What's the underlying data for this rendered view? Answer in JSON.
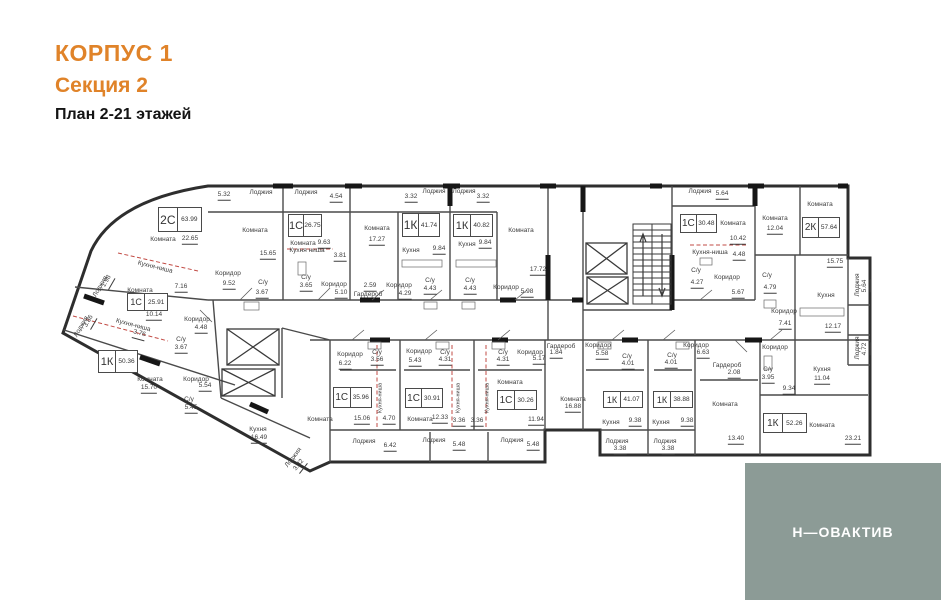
{
  "header": {
    "building": "КОРПУС 1",
    "section": "Секция 2",
    "plan_title": "План 2-21 этажей"
  },
  "logo": {
    "text": "Н—ОВАКТИВ",
    "bg": "#8C9B96"
  },
  "colors": {
    "accent_orange": "#E08329",
    "wall_dark": "#2E2E2E",
    "wall_inner": "#4A4A4A",
    "red_dashed": "#C24B45",
    "logo_bg": "#8C9B96"
  },
  "plan": {
    "apartments": [
      {
        "type": "2С",
        "area": "63.99",
        "x": 158,
        "y": 207,
        "w": 44,
        "h": 25
      },
      {
        "type": "1С",
        "area": "26.75",
        "x": 288,
        "y": 214,
        "w": 34,
        "h": 23
      },
      {
        "type": "1К",
        "area": "41.74",
        "x": 402,
        "y": 213,
        "w": 38,
        "h": 24
      },
      {
        "type": "1К",
        "area": "40.82",
        "x": 453,
        "y": 214,
        "w": 40,
        "h": 23
      },
      {
        "type": "1С",
        "area": "30.48",
        "x": 680,
        "y": 214,
        "w": 37,
        "h": 19
      },
      {
        "type": "2К",
        "area": "57.64",
        "x": 802,
        "y": 217,
        "w": 38,
        "h": 21
      },
      {
        "type": "1С",
        "area": "25.91",
        "x": 127,
        "y": 293,
        "w": 41,
        "h": 18
      },
      {
        "type": "1К",
        "area": "50.36",
        "x": 98,
        "y": 350,
        "w": 40,
        "h": 23
      },
      {
        "type": "1С",
        "area": "35.96",
        "x": 333,
        "y": 387,
        "w": 39,
        "h": 21
      },
      {
        "type": "1С",
        "area": "30.91",
        "x": 405,
        "y": 388,
        "w": 38,
        "h": 20
      },
      {
        "type": "1С",
        "area": "30.26",
        "x": 497,
        "y": 390,
        "w": 40,
        "h": 20
      },
      {
        "type": "1К",
        "area": "41.07",
        "x": 603,
        "y": 391,
        "w": 40,
        "h": 17
      },
      {
        "type": "1К",
        "area": "38.88",
        "x": 653,
        "y": 391,
        "w": 40,
        "h": 17
      },
      {
        "type": "1К",
        "area": "52.26",
        "x": 763,
        "y": 413,
        "w": 44,
        "h": 20
      }
    ],
    "labels": [
      {
        "t": "5.32",
        "x": 224,
        "y": 196,
        "u": 1
      },
      {
        "t": "Лоджия",
        "x": 261,
        "y": 193
      },
      {
        "t": "Лоджия",
        "x": 306,
        "y": 193
      },
      {
        "t": "4.54",
        "x": 336,
        "y": 198,
        "u": 1
      },
      {
        "t": "3.32",
        "x": 411,
        "y": 198,
        "u": 1
      },
      {
        "t": "Лоджия",
        "x": 434,
        "y": 192
      },
      {
        "t": "Лоджия",
        "x": 464,
        "y": 192
      },
      {
        "t": "3.32",
        "x": 483,
        "y": 198,
        "u": 1
      },
      {
        "t": "Лоджия",
        "x": 700,
        "y": 192
      },
      {
        "t": "5.64",
        "x": 722,
        "y": 195,
        "u": 1
      },
      {
        "t": "Комната",
        "x": 163,
        "y": 240
      },
      {
        "t": "22.65",
        "x": 190,
        "y": 240,
        "u": 1
      },
      {
        "t": "Комната",
        "x": 255,
        "y": 231
      },
      {
        "t": "15.65",
        "x": 268,
        "y": 255,
        "u": 1
      },
      {
        "t": "Кухня-ниша",
        "x": 155,
        "y": 268,
        "r": 14
      },
      {
        "t": "7.16",
        "x": 181,
        "y": 288,
        "u": 1
      },
      {
        "t": "Коридор",
        "x": 228,
        "y": 274
      },
      {
        "t": "9.52",
        "x": 229,
        "y": 285,
        "u": 1
      },
      {
        "t": "С/у",
        "x": 263,
        "y": 283
      },
      {
        "t": "3.67",
        "x": 262,
        "y": 294,
        "u": 1
      },
      {
        "t": "Комната",
        "x": 303,
        "y": 244
      },
      {
        "t": "9.63",
        "x": 324,
        "y": 244,
        "u": 1
      },
      {
        "t": "Кухня ниша",
        "x": 307,
        "y": 251
      },
      {
        "t": "3.81",
        "x": 340,
        "y": 257,
        "u": 1
      },
      {
        "t": "С/у",
        "x": 306,
        "y": 278
      },
      {
        "t": "3.65",
        "x": 306,
        "y": 287,
        "u": 1
      },
      {
        "t": "Коридор",
        "x": 334,
        "y": 285
      },
      {
        "t": "5.10",
        "x": 341,
        "y": 294,
        "u": 1
      },
      {
        "t": "2.59",
        "x": 370,
        "y": 287,
        "u": 1
      },
      {
        "t": "Гардероб",
        "x": 368,
        "y": 295
      },
      {
        "t": "Комната",
        "x": 377,
        "y": 229
      },
      {
        "t": "17.27",
        "x": 377,
        "y": 241,
        "u": 1
      },
      {
        "t": "Кухня",
        "x": 411,
        "y": 251
      },
      {
        "t": "9.84",
        "x": 439,
        "y": 250,
        "u": 1
      },
      {
        "t": "Коридор",
        "x": 399,
        "y": 286
      },
      {
        "t": "4.29",
        "x": 405,
        "y": 295,
        "u": 1
      },
      {
        "t": "С/у",
        "x": 430,
        "y": 281
      },
      {
        "t": "4.43",
        "x": 430,
        "y": 290,
        "u": 1
      },
      {
        "t": "Кухня",
        "x": 467,
        "y": 245
      },
      {
        "t": "9.84",
        "x": 485,
        "y": 244,
        "u": 1
      },
      {
        "t": "С/у",
        "x": 470,
        "y": 281
      },
      {
        "t": "4.43",
        "x": 470,
        "y": 290,
        "u": 1
      },
      {
        "t": "Комната",
        "x": 521,
        "y": 231
      },
      {
        "t": "17.72",
        "x": 538,
        "y": 271,
        "u": 1
      },
      {
        "t": "Коридор",
        "x": 506,
        "y": 288
      },
      {
        "t": "5.98",
        "x": 527,
        "y": 293,
        "u": 1
      },
      {
        "t": "Комната",
        "x": 733,
        "y": 224
      },
      {
        "t": "10.42",
        "x": 738,
        "y": 240,
        "u": 1
      },
      {
        "t": "Кухня-ниша",
        "x": 710,
        "y": 253
      },
      {
        "t": "4.48",
        "x": 739,
        "y": 256,
        "u": 1
      },
      {
        "t": "С/у",
        "x": 696,
        "y": 271
      },
      {
        "t": "4.27",
        "x": 697,
        "y": 284,
        "u": 1
      },
      {
        "t": "Коридор",
        "x": 727,
        "y": 278
      },
      {
        "t": "5.67",
        "x": 738,
        "y": 294,
        "u": 1
      },
      {
        "t": "Комната",
        "x": 820,
        "y": 205
      },
      {
        "t": "Комната",
        "x": 775,
        "y": 219
      },
      {
        "t": "12.04",
        "x": 775,
        "y": 230,
        "u": 1
      },
      {
        "t": "15.75",
        "x": 835,
        "y": 263,
        "u": 1
      },
      {
        "t": "С/у",
        "x": 767,
        "y": 276
      },
      {
        "t": "4.79",
        "x": 770,
        "y": 289,
        "u": 1
      },
      {
        "t": "Кухня",
        "x": 826,
        "y": 296
      },
      {
        "t": "12.17",
        "x": 833,
        "y": 328,
        "u": 1
      },
      {
        "t": "Коридор",
        "x": 784,
        "y": 312
      },
      {
        "t": "7.41",
        "x": 785,
        "y": 325,
        "u": 1
      },
      {
        "t": "Лоджия",
        "x": 858,
        "y": 285,
        "r": -90
      },
      {
        "t": "5.64",
        "x": 866,
        "y": 286,
        "r": -90,
        "u": 1
      },
      {
        "t": "Лоджия",
        "x": 858,
        "y": 348,
        "r": -90
      },
      {
        "t": "4.72",
        "x": 866,
        "y": 349,
        "r": -90,
        "u": 1
      },
      {
        "t": "Лоджия",
        "x": 101,
        "y": 287,
        "r": -60
      },
      {
        "t": "1.98",
        "x": 108,
        "y": 282,
        "r": -60,
        "u": 1
      },
      {
        "t": "Лоджия",
        "x": 82,
        "y": 327,
        "r": -60
      },
      {
        "t": "3.86",
        "x": 90,
        "y": 322,
        "r": -60,
        "u": 1
      },
      {
        "t": "Комната",
        "x": 140,
        "y": 291
      },
      {
        "t": "10.14",
        "x": 154,
        "y": 316,
        "u": 1
      },
      {
        "t": "Кухня-ниша",
        "x": 133,
        "y": 326,
        "r": 15
      },
      {
        "t": "3.76",
        "x": 139,
        "y": 335,
        "u": 1,
        "r": 15
      },
      {
        "t": "Коридор",
        "x": 197,
        "y": 320
      },
      {
        "t": "4.48",
        "x": 201,
        "y": 329,
        "u": 1
      },
      {
        "t": "С/у",
        "x": 181,
        "y": 340
      },
      {
        "t": "3.67",
        "x": 181,
        "y": 349,
        "u": 1
      },
      {
        "t": "Комната",
        "x": 150,
        "y": 380
      },
      {
        "t": "15.70",
        "x": 149,
        "y": 389,
        "u": 1
      },
      {
        "t": "Коридор",
        "x": 196,
        "y": 380
      },
      {
        "t": "5.54",
        "x": 205,
        "y": 387,
        "u": 1
      },
      {
        "t": "С/у",
        "x": 189,
        "y": 400
      },
      {
        "t": "5.45",
        "x": 191,
        "y": 409,
        "u": 1
      },
      {
        "t": "Кухня",
        "x": 258,
        "y": 430
      },
      {
        "t": "16.49",
        "x": 259,
        "y": 439,
        "u": 1
      },
      {
        "t": "Лоджия",
        "x": 294,
        "y": 458,
        "r": -52
      },
      {
        "t": "3.32",
        "x": 300,
        "y": 466,
        "r": -52,
        "u": 1
      },
      {
        "t": "Коридор",
        "x": 350,
        "y": 355
      },
      {
        "t": "6.22",
        "x": 345,
        "y": 365,
        "u": 1
      },
      {
        "t": "С/у",
        "x": 377,
        "y": 353
      },
      {
        "t": "3.56",
        "x": 377,
        "y": 361,
        "u": 1
      },
      {
        "t": "Комната",
        "x": 320,
        "y": 420
      },
      {
        "t": "15.06",
        "x": 362,
        "y": 420,
        "u": 1
      },
      {
        "t": "4.70",
        "x": 389,
        "y": 420,
        "u": 1
      },
      {
        "t": "Кухня-ниша",
        "x": 381,
        "y": 398,
        "r": -90,
        "s": 5.5
      },
      {
        "t": "Коридор",
        "x": 419,
        "y": 352
      },
      {
        "t": "5.43",
        "x": 415,
        "y": 362,
        "u": 1
      },
      {
        "t": "С/у",
        "x": 445,
        "y": 353
      },
      {
        "t": "4.31",
        "x": 445,
        "y": 361,
        "u": 1
      },
      {
        "t": "Комната",
        "x": 420,
        "y": 420
      },
      {
        "t": "12.33",
        "x": 440,
        "y": 419,
        "u": 1
      },
      {
        "t": "Кухня-ниша",
        "x": 459,
        "y": 398,
        "r": -90,
        "s": 5.5
      },
      {
        "t": "3.36",
        "x": 459,
        "y": 422,
        "u": 1
      },
      {
        "t": "Кухня-ниша",
        "x": 488,
        "y": 398,
        "r": -90,
        "s": 5.5
      },
      {
        "t": "3.36",
        "x": 477,
        "y": 422,
        "u": 1
      },
      {
        "t": "С/у",
        "x": 503,
        "y": 353
      },
      {
        "t": "4.31",
        "x": 503,
        "y": 361,
        "u": 1
      },
      {
        "t": "Коридор",
        "x": 530,
        "y": 353
      },
      {
        "t": "5.17",
        "x": 539,
        "y": 360,
        "u": 1
      },
      {
        "t": "Комната",
        "x": 510,
        "y": 383
      },
      {
        "t": "11.94",
        "x": 536,
        "y": 421,
        "u": 1
      },
      {
        "t": "Гардероб",
        "x": 561,
        "y": 347
      },
      {
        "t": "1.84",
        "x": 556,
        "y": 354,
        "u": 1
      },
      {
        "t": "Коридор",
        "x": 598,
        "y": 346
      },
      {
        "t": "5.58",
        "x": 602,
        "y": 355,
        "u": 1
      },
      {
        "t": "С/у",
        "x": 627,
        "y": 357
      },
      {
        "t": "4.01",
        "x": 628,
        "y": 365,
        "u": 1
      },
      {
        "t": "Комната",
        "x": 573,
        "y": 400
      },
      {
        "t": "16.88",
        "x": 573,
        "y": 408,
        "u": 1
      },
      {
        "t": "Кухня",
        "x": 611,
        "y": 423
      },
      {
        "t": "9.38",
        "x": 635,
        "y": 422,
        "u": 1
      },
      {
        "t": "С/у",
        "x": 672,
        "y": 356
      },
      {
        "t": "4.01",
        "x": 671,
        "y": 364,
        "u": 1
      },
      {
        "t": "Коридор",
        "x": 696,
        "y": 346
      },
      {
        "t": "6.63",
        "x": 703,
        "y": 354,
        "u": 1
      },
      {
        "t": "Кухня",
        "x": 661,
        "y": 423
      },
      {
        "t": "9.38",
        "x": 687,
        "y": 422,
        "u": 1
      },
      {
        "t": "Комната",
        "x": 725,
        "y": 405
      },
      {
        "t": "13.40",
        "x": 736,
        "y": 440,
        "u": 1
      },
      {
        "t": "Гардероб",
        "x": 727,
        "y": 366
      },
      {
        "t": "2.08",
        "x": 734,
        "y": 374,
        "u": 1
      },
      {
        "t": "С/у",
        "x": 768,
        "y": 370
      },
      {
        "t": "3.95",
        "x": 768,
        "y": 379,
        "u": 1
      },
      {
        "t": "Кухня",
        "x": 822,
        "y": 370
      },
      {
        "t": "11.04",
        "x": 822,
        "y": 380,
        "u": 1
      },
      {
        "t": "Коридор",
        "x": 775,
        "y": 348
      },
      {
        "t": "9.34",
        "x": 789,
        "y": 390,
        "u": 1
      },
      {
        "t": "Комната",
        "x": 822,
        "y": 426
      },
      {
        "t": "23.21",
        "x": 853,
        "y": 440,
        "u": 1
      },
      {
        "t": "Лоджия",
        "x": 364,
        "y": 442
      },
      {
        "t": "6.42",
        "x": 390,
        "y": 447,
        "u": 1
      },
      {
        "t": "Лоджия",
        "x": 434,
        "y": 441
      },
      {
        "t": "5.48",
        "x": 459,
        "y": 446,
        "u": 1
      },
      {
        "t": "Лоджия",
        "x": 512,
        "y": 441
      },
      {
        "t": "5.48",
        "x": 533,
        "y": 446,
        "u": 1
      },
      {
        "t": "Лоджия",
        "x": 617,
        "y": 442
      },
      {
        "t": "3.38",
        "x": 620,
        "y": 450,
        "u": 1
      },
      {
        "t": "Лоджия",
        "x": 665,
        "y": 442
      },
      {
        "t": "3.38",
        "x": 668,
        "y": 450,
        "u": 1
      }
    ]
  }
}
